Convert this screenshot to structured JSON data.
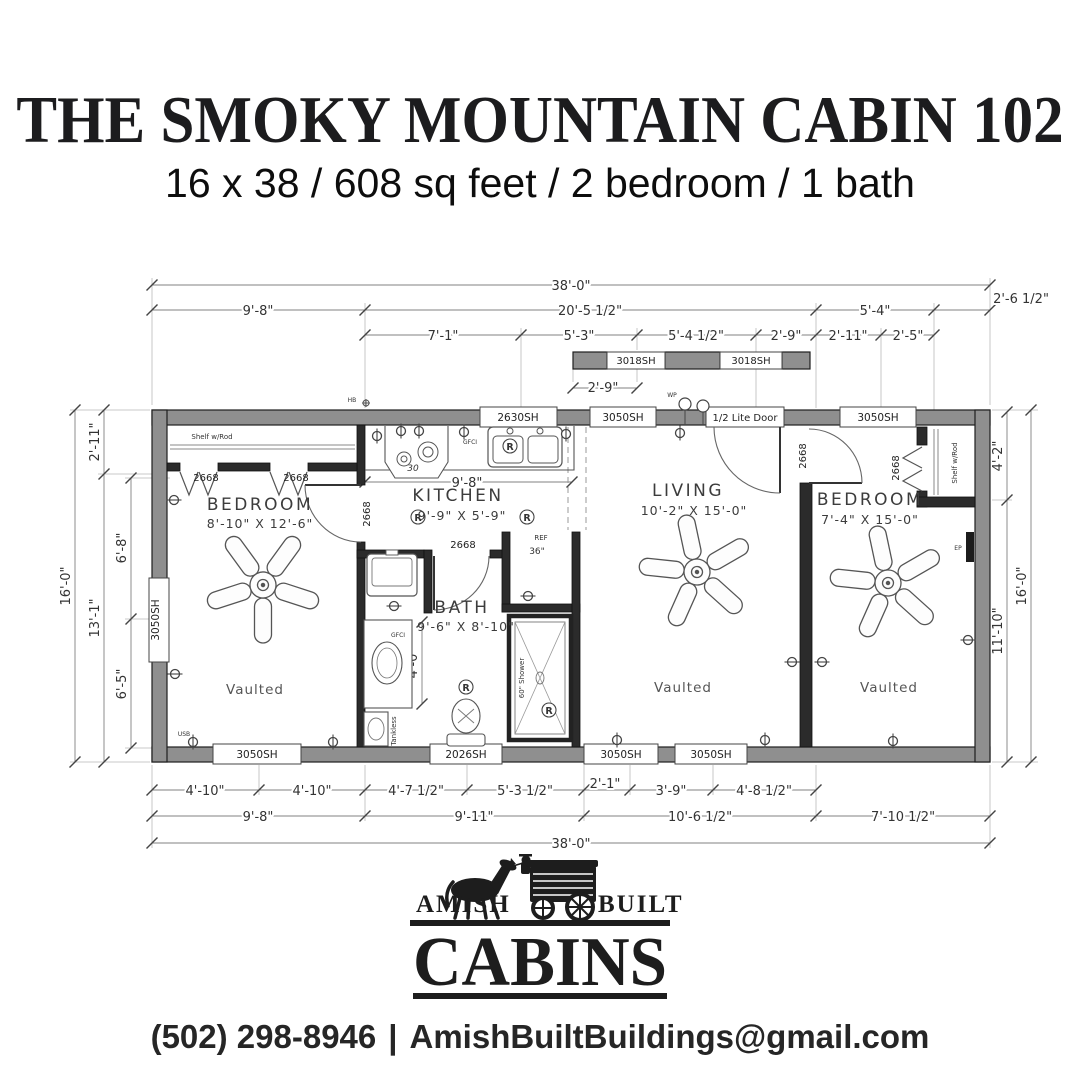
{
  "header": {
    "title": "THE SMOKY MOUNTAIN CABIN 102",
    "subtitle": "16 x 38 / 608 sq feet / 2 bedroom / 1 bath"
  },
  "plan": {
    "rooms": {
      "bedroom_left": {
        "name": "BEDROOM",
        "dims": "8'-10\" X 12'-6\"",
        "note": "Vaulted"
      },
      "kitchen": {
        "name": "KITCHEN",
        "dims": "9'-9\" X 5'-9\""
      },
      "bath": {
        "name": "BATH",
        "dims": "9'-6\" X 8'-10\""
      },
      "living": {
        "name": "LIVING",
        "dims": "10'-2\" X 15'-0\"",
        "note": "Vaulted"
      },
      "bedroom_right": {
        "name": "BEDROOM",
        "dims": "7'-4\" X 15'-0\"",
        "note": "Vaulted"
      }
    },
    "windows": {
      "top_kitchen": "2630SH",
      "top_living": "3050SH",
      "entry_door": "1/2 Lite Door",
      "top_bedroom_right": "3050SH",
      "dormer_a": "3018SH",
      "dormer_b": "3018SH",
      "left_bedroom": "3050SH",
      "bottom_bedroom_left": "3050SH",
      "bottom_bath": "2026SH",
      "bottom_living_a": "3050SH",
      "bottom_living_b": "3050SH"
    },
    "doors": {
      "closet_left_a": "2668",
      "closet_left_b": "2668",
      "bedroom_left": "2668",
      "bath": "2668",
      "bedroom_right": "2668",
      "closet_right": "2668"
    },
    "closets": {
      "shelf_rod_left": "Shelf w/Rod",
      "shelf_rod_right": "Shelf w/Rod"
    },
    "fixtures": {
      "range": "30",
      "fridge": "REF",
      "fridge_width": "36\"",
      "shower": "60\" Shower",
      "tankless": "Tankless",
      "gfci_kitchen": "GFCI",
      "gfci_bath": "GFCI",
      "recessed": "R",
      "wp": "WP",
      "hb": "HB",
      "usb": "USB",
      "ep": "EP",
      "kitchen_inner_dim": "9'-8\"",
      "bath_inner_dim": "4'-0\""
    },
    "dims": {
      "top_overall": "38'-0\"",
      "top_row2": [
        "9'-8\"",
        "20'-5 1/2\"",
        "5'-4\"",
        "2'-6 1/2\""
      ],
      "top_row3": [
        "7'-1\"",
        "5'-3\"",
        "5'-4 1/2\"",
        "2'-9\"",
        "2'-11\"",
        "2'-5\""
      ],
      "dormer": "2'-9\"",
      "bottom_row1": [
        "4'-10\"",
        "4'-10\"",
        "4'-7 1/2\"",
        "5'-3 1/2\"",
        "2'-1\"",
        "3'-9\"",
        "4'-8 1/2\""
      ],
      "bottom_row2": [
        "9'-8\"",
        "9'-11\"",
        "10'-6 1/2\"",
        "7'-10 1/2\""
      ],
      "bottom_overall": "38'-0\"",
      "left_overall": "16'-0\"",
      "left_outer": [
        "2'-11\"",
        "13'-1\""
      ],
      "left_inner": [
        "6'-8\"",
        "6'-5\""
      ],
      "right_outer": [
        "4'-2\"",
        "11'-10\""
      ],
      "right_overall": "16'-0\""
    }
  },
  "logo": {
    "amish": "AMISH",
    "built": "BUILT",
    "cabins": "CABINS"
  },
  "contact": {
    "phone": "(502) 298-8946",
    "separator": "|",
    "email": "AmishBuiltBuildings@gmail.com"
  }
}
